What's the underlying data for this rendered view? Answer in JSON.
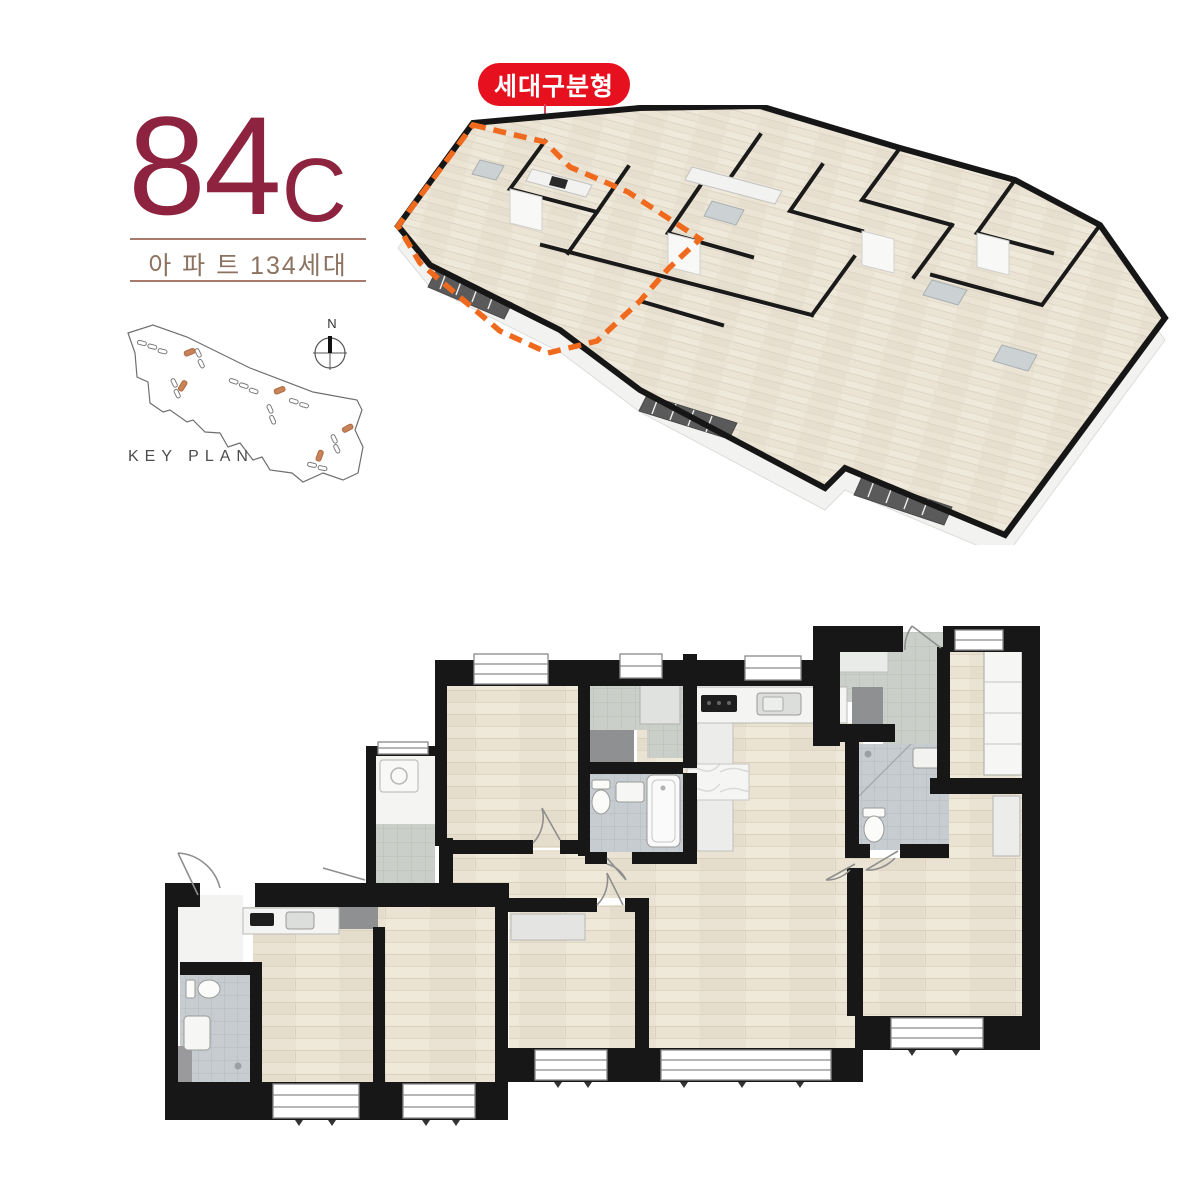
{
  "header": {
    "unit_number": "84",
    "unit_letter": "C",
    "subtitle": "아 파 트 134세대"
  },
  "badge": {
    "label": "세대구분형"
  },
  "keyplan": {
    "label": "KEY PLAN",
    "compass_north": "N"
  },
  "colors": {
    "title_red": "#8e2340",
    "subtitle_brown": "#8c7260",
    "divider": "#aa7a6c",
    "badge_red": "#e7101e",
    "pointer_red": "#d8485e",
    "unit_outline_orange": "#f06a1e",
    "wall_black": "#171717",
    "wood_floor": "#e9e2d2",
    "tile_gray": "#c9cec8",
    "bath_tile": "#c5cacd",
    "dark_duct": "#8e9092",
    "keyplan_line": "#4c4c4c"
  }
}
